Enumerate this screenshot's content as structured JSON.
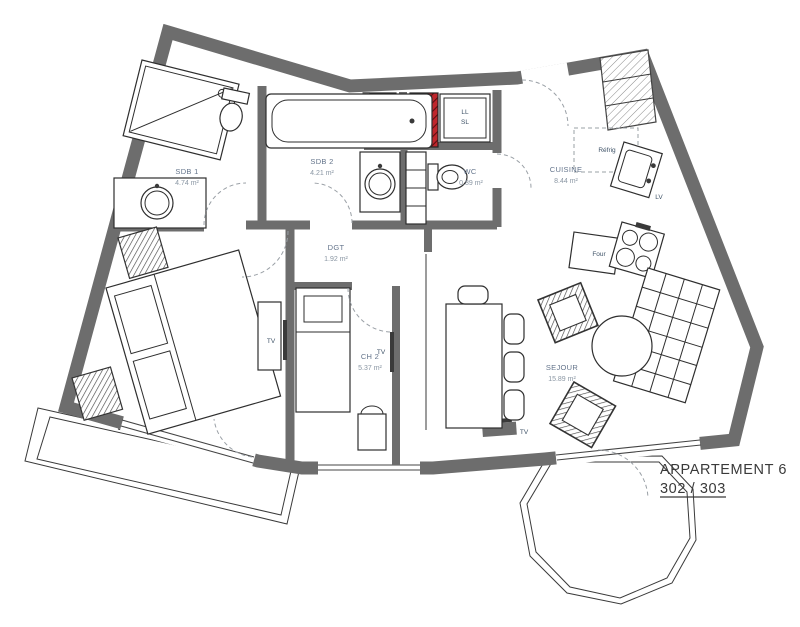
{
  "title": {
    "name": "APPARTEMENT 6",
    "units": "302 / 303"
  },
  "rooms": [
    {
      "name": "SDB 1",
      "area": "4.74 m²"
    },
    {
      "name": "SDB 2",
      "area": "4.21 m²"
    },
    {
      "name": "WC",
      "area": "0.89 m²"
    },
    {
      "name": "CUISINE",
      "area": "8.44 m²"
    },
    {
      "name": "DGT",
      "area": "1.92 m²"
    },
    {
      "name": "CH 2",
      "area": "5.37 m²"
    },
    {
      "name": "SEJOUR",
      "area": "15.89 m²"
    }
  ],
  "labels": {
    "washer": "LL",
    "dryer": "SL",
    "fridge": "Réfrig",
    "dishwasher": "LV",
    "oven": "Four",
    "tv": "TV"
  },
  "colors": {
    "wall": "#6d6d6d",
    "duct": "#c0262c",
    "room-label": "#64748b",
    "area-label": "#8a96a3",
    "appliance-label": "#3d5166",
    "title-color": "#3a3a3a"
  }
}
